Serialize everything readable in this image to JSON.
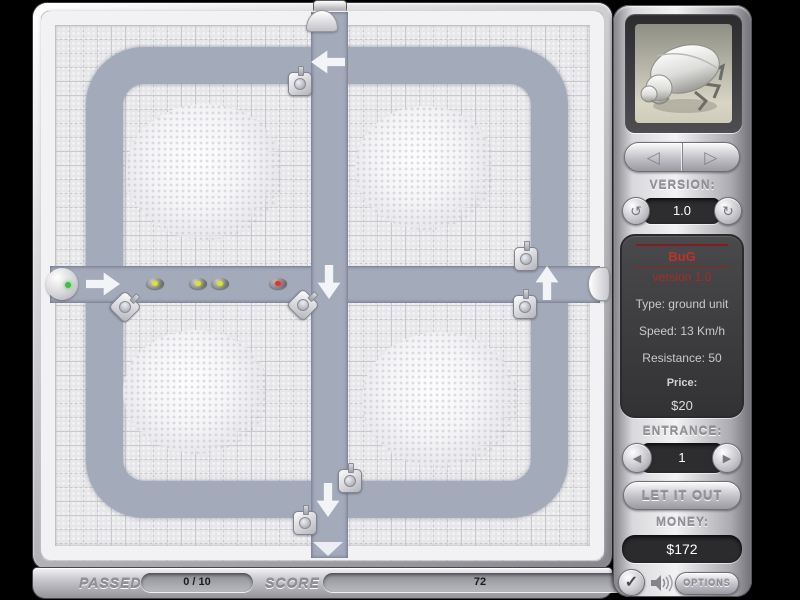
{
  "sidebar": {
    "unit_preview_icon": "beetle",
    "prev_arrow": "◁",
    "next_arrow": "▷",
    "version_label": "VERSION:",
    "version_value": "1.0",
    "version_prev_icon": "↺",
    "version_next_icon": "↻",
    "info": {
      "name": "BuG",
      "version": "version 1.0",
      "type": "Type: ground unit",
      "speed": "Speed: 13 Km/h",
      "resistance": "Resistance: 50",
      "price_label": "Price:",
      "price_value": "$20"
    },
    "entrance_label": "ENTRANCE:",
    "entrance_value": "1",
    "entrance_prev_icon": "◀",
    "entrance_next_icon": "▶",
    "release_button": "LET IT OUT",
    "money_label": "MONEY:",
    "money_value": "$172",
    "check_icon": "✓",
    "options_button": "OPTIONS"
  },
  "statusbar": {
    "passed_label": "PASSED",
    "passed_value": "0 / 10",
    "score_label": "SCORE",
    "score_value": "72"
  },
  "colors": {
    "path": "#a3aaba",
    "accent_red": "#c23028",
    "bug_dot_yellow": "#d8e23a",
    "bug_dot_red": "#d63a2a",
    "entrance_dot_green": "#39c23f"
  },
  "board": {
    "mounds": [
      {
        "x": 205,
        "y": 172,
        "w": 158,
        "h": 136
      },
      {
        "x": 425,
        "y": 168,
        "w": 140,
        "h": 124
      },
      {
        "x": 196,
        "y": 392,
        "w": 146,
        "h": 124
      },
      {
        "x": 440,
        "y": 400,
        "w": 156,
        "h": 136
      }
    ],
    "arrows": [
      {
        "x": 103,
        "y": 284,
        "dir": "right"
      },
      {
        "x": 328,
        "y": 62,
        "dir": "left"
      },
      {
        "x": 329,
        "y": 282,
        "dir": "down"
      },
      {
        "x": 547,
        "y": 283,
        "dir": "up"
      },
      {
        "x": 328,
        "y": 500,
        "dir": "down"
      }
    ],
    "turrets": [
      {
        "x": 300,
        "y": 84,
        "r": 0
      },
      {
        "x": 125,
        "y": 307,
        "r": 45
      },
      {
        "x": 303,
        "y": 305,
        "r": 45
      },
      {
        "x": 526,
        "y": 259,
        "r": 0
      },
      {
        "x": 525,
        "y": 307,
        "r": 0
      },
      {
        "x": 350,
        "y": 481,
        "r": 0
      },
      {
        "x": 305,
        "y": 523,
        "r": 0
      }
    ],
    "bugs": [
      {
        "x": 155,
        "y": 283,
        "dot": "#d8e23a"
      },
      {
        "x": 198,
        "y": 283,
        "dot": "#d8e23a"
      },
      {
        "x": 220,
        "y": 283,
        "dot": "#d8e23a"
      },
      {
        "x": 278,
        "y": 283,
        "dot": "#d63a2a"
      }
    ],
    "portals": [
      {
        "x": 62,
        "y": 284,
        "kind": "sphere"
      },
      {
        "x": 322,
        "y": 21,
        "kind": "dome"
      },
      {
        "x": 599,
        "y": 284,
        "kind": "dome-side"
      },
      {
        "x": 328,
        "y": 549,
        "kind": "triangle"
      }
    ]
  }
}
